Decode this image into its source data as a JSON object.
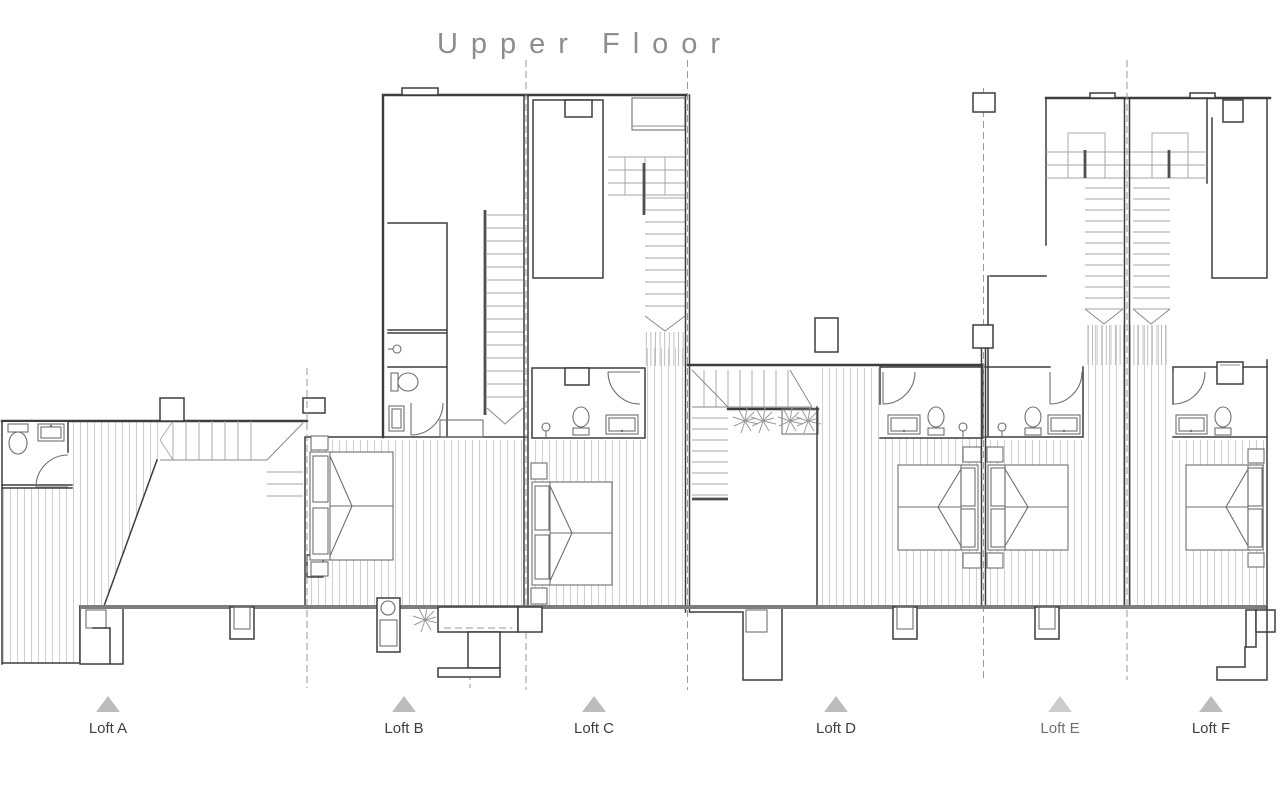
{
  "title": "Upper Floor",
  "lofts": [
    {
      "id": "a",
      "label": "Loft A"
    },
    {
      "id": "b",
      "label": "Loft B"
    },
    {
      "id": "c",
      "label": "Loft C"
    },
    {
      "id": "d",
      "label": "Loft D"
    },
    {
      "id": "e",
      "label": "Loft E"
    },
    {
      "id": "f",
      "label": "Loft F"
    }
  ],
  "colors": {
    "wall": "#3d3d3d",
    "thick_wall": "#7d7d7d",
    "hatch": "#cfcfcf",
    "stair": "#a5a5a5",
    "title": "#8d8d8d",
    "label": "#3f3f3f",
    "triangle": "#bcbcbc"
  }
}
